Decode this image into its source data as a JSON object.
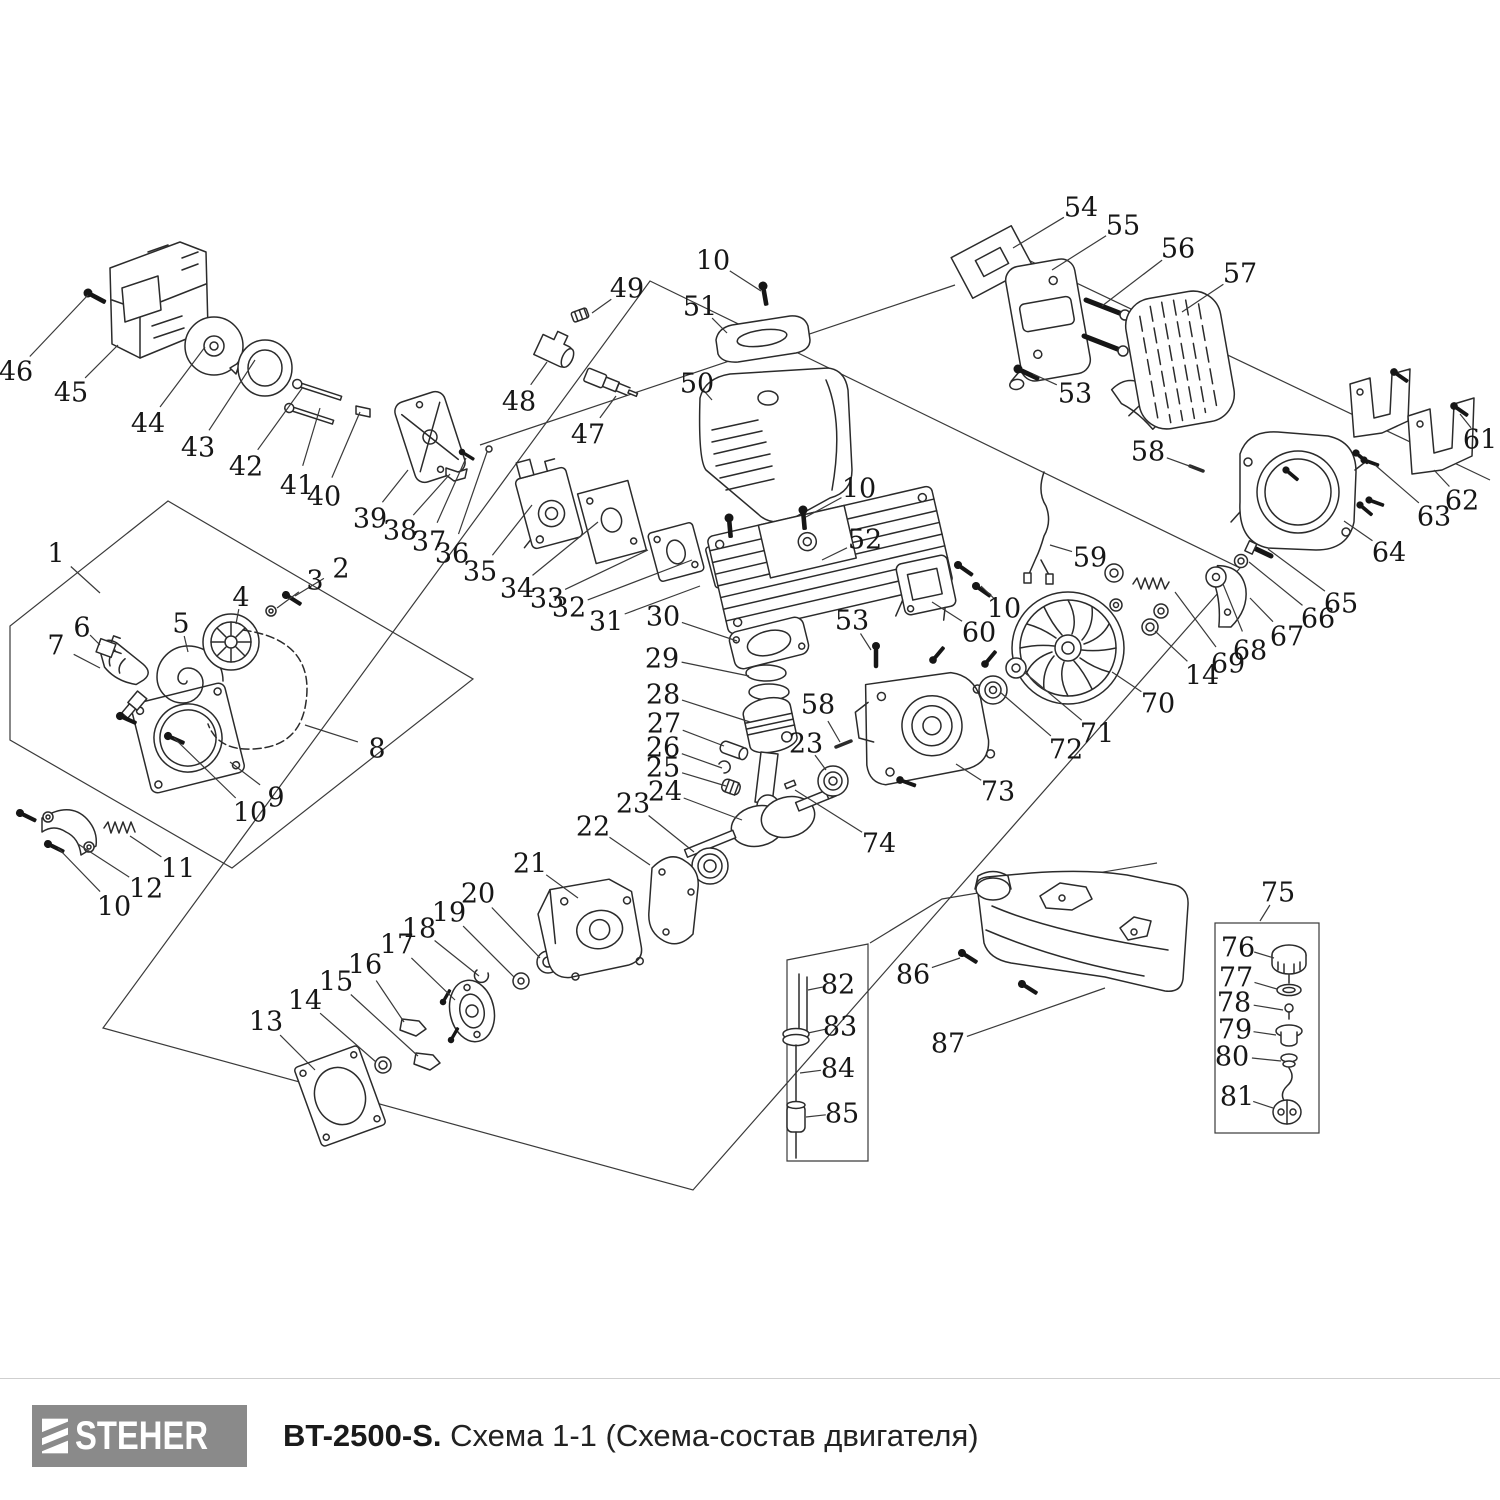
{
  "footer": {
    "brand": "STEHER",
    "model": "BT-2500-S.",
    "subtitle": "Схема 1-1 (Схема-состав двигателя)"
  },
  "colors": {
    "ink": "#2b2b2b",
    "label": "#161616",
    "leader": "#3a3a3a",
    "logo_bg": "#8a8a8a",
    "logo_fg": "#ffffff",
    "rule": "#cfcfcf"
  },
  "diagram": {
    "label_font_size": 27,
    "labels": [
      {
        "n": "46",
        "x": 16,
        "y": 371,
        "tx": 88,
        "ty": 295
      },
      {
        "n": "45",
        "x": 71,
        "y": 392,
        "tx": 118,
        "ty": 345
      },
      {
        "n": "44",
        "x": 148,
        "y": 423,
        "tx": 205,
        "ty": 347
      },
      {
        "n": "43",
        "x": 198,
        "y": 447,
        "tx": 255,
        "ty": 360
      },
      {
        "n": "42",
        "x": 246,
        "y": 466,
        "tx": 303,
        "ty": 387
      },
      {
        "n": "41",
        "x": 297,
        "y": 485,
        "tx": 320,
        "ty": 408
      },
      {
        "n": "40",
        "x": 324,
        "y": 496,
        "tx": 360,
        "ty": 412
      },
      {
        "n": "39",
        "x": 370,
        "y": 518,
        "tx": 408,
        "ty": 470
      },
      {
        "n": "38",
        "x": 400,
        "y": 530,
        "tx": 450,
        "ty": 474
      },
      {
        "n": "37",
        "x": 429,
        "y": 541,
        "tx": 466,
        "ty": 458
      },
      {
        "n": "36",
        "x": 452,
        "y": 553,
        "tx": 487,
        "ty": 452
      },
      {
        "n": "35",
        "x": 480,
        "y": 571,
        "tx": 532,
        "ty": 505
      },
      {
        "n": "34",
        "x": 517,
        "y": 588,
        "tx": 598,
        "ty": 522
      },
      {
        "n": "33",
        "x": 547,
        "y": 598,
        "tx": 648,
        "ty": 550
      },
      {
        "n": "32",
        "x": 569,
        "y": 607,
        "tx": 692,
        "ty": 560
      },
      {
        "n": "31",
        "x": 606,
        "y": 621,
        "tx": 700,
        "ty": 586
      },
      {
        "n": "30",
        "x": 663,
        "y": 616,
        "tx": 737,
        "ty": 641
      },
      {
        "n": "29",
        "x": 662,
        "y": 658,
        "tx": 749,
        "ty": 676
      },
      {
        "n": "28",
        "x": 663,
        "y": 694,
        "tx": 750,
        "ty": 722
      },
      {
        "n": "27",
        "x": 664,
        "y": 723,
        "tx": 724,
        "ty": 746
      },
      {
        "n": "26",
        "x": 663,
        "y": 747,
        "tx": 722,
        "ty": 768
      },
      {
        "n": "25",
        "x": 663,
        "y": 767,
        "tx": 726,
        "ty": 786
      },
      {
        "n": "24",
        "x": 665,
        "y": 791,
        "tx": 742,
        "ty": 820
      },
      {
        "n": "23",
        "x": 633,
        "y": 803,
        "tx": 694,
        "ty": 852
      },
      {
        "n": "22",
        "x": 593,
        "y": 826,
        "tx": 650,
        "ty": 865
      },
      {
        "n": "21",
        "x": 530,
        "y": 863,
        "tx": 578,
        "ty": 898
      },
      {
        "n": "20",
        "x": 478,
        "y": 893,
        "tx": 540,
        "ty": 958
      },
      {
        "n": "19",
        "x": 449,
        "y": 912,
        "tx": 514,
        "ty": 977
      },
      {
        "n": "18",
        "x": 419,
        "y": 928,
        "tx": 479,
        "ty": 976
      },
      {
        "n": "17",
        "x": 397,
        "y": 944,
        "tx": 455,
        "ty": 1000
      },
      {
        "n": "16",
        "x": 365,
        "y": 964,
        "tx": 404,
        "ty": 1022
      },
      {
        "n": "15",
        "x": 336,
        "y": 981,
        "tx": 418,
        "ty": 1056
      },
      {
        "n": "14",
        "x": 305,
        "y": 1000,
        "tx": 376,
        "ty": 1062
      },
      {
        "n": "13",
        "x": 266,
        "y": 1021,
        "tx": 315,
        "ty": 1070
      },
      {
        "n": "1",
        "x": 56,
        "y": 553,
        "tx": 100,
        "ty": 593
      },
      {
        "n": "2",
        "x": 341,
        "y": 568,
        "tx": 295,
        "ty": 596
      },
      {
        "n": "3",
        "x": 315,
        "y": 580,
        "tx": 277,
        "ty": 608
      },
      {
        "n": "4",
        "x": 241,
        "y": 597,
        "tx": 236,
        "ty": 624
      },
      {
        "n": "5",
        "x": 181,
        "y": 623,
        "tx": 188,
        "ty": 652
      },
      {
        "n": "6",
        "x": 82,
        "y": 627,
        "tx": 100,
        "ty": 645
      },
      {
        "n": "7",
        "x": 56,
        "y": 645,
        "tx": 100,
        "ty": 668
      },
      {
        "n": "8",
        "x": 377,
        "y": 748,
        "tx": 305,
        "ty": 725
      },
      {
        "n": "9",
        "x": 276,
        "y": 797,
        "tx": 230,
        "ty": 762
      },
      {
        "n": "10",
        "x": 250,
        "y": 812,
        "tx": 174,
        "ty": 738
      },
      {
        "n": "11",
        "x": 178,
        "y": 868,
        "tx": 130,
        "ty": 836
      },
      {
        "n": "12",
        "x": 146,
        "y": 888,
        "tx": 78,
        "ty": 844
      },
      {
        "n": "10",
        "x": 114,
        "y": 906,
        "tx": 58,
        "ty": 848
      },
      {
        "n": "47",
        "x": 588,
        "y": 434,
        "tx": 616,
        "ty": 396
      },
      {
        "n": "48",
        "x": 519,
        "y": 401,
        "tx": 547,
        "ty": 362
      },
      {
        "n": "49",
        "x": 627,
        "y": 288,
        "tx": 592,
        "ty": 313
      },
      {
        "n": "50",
        "x": 697,
        "y": 383,
        "tx": 712,
        "ty": 400
      },
      {
        "n": "51",
        "x": 700,
        "y": 306,
        "tx": 727,
        "ty": 333
      },
      {
        "n": "10",
        "x": 713,
        "y": 260,
        "tx": 761,
        "ty": 291
      },
      {
        "n": "52",
        "x": 865,
        "y": 539,
        "tx": 822,
        "ty": 560
      },
      {
        "n": "10",
        "x": 859,
        "y": 488,
        "tx": 806,
        "ty": 517
      },
      {
        "n": "53",
        "x": 1075,
        "y": 393,
        "tx": 1033,
        "ty": 374
      },
      {
        "n": "54",
        "x": 1081,
        "y": 207,
        "tx": 1013,
        "ty": 248
      },
      {
        "n": "55",
        "x": 1123,
        "y": 225,
        "tx": 1052,
        "ty": 270
      },
      {
        "n": "56",
        "x": 1178,
        "y": 248,
        "tx": 1102,
        "ty": 306
      },
      {
        "n": "57",
        "x": 1240,
        "y": 273,
        "tx": 1182,
        "ty": 312
      },
      {
        "n": "58",
        "x": 1148,
        "y": 451,
        "tx": 1192,
        "ty": 467
      },
      {
        "n": "59",
        "x": 1090,
        "y": 557,
        "tx": 1050,
        "ty": 545
      },
      {
        "n": "60",
        "x": 979,
        "y": 632,
        "tx": 932,
        "ty": 602
      },
      {
        "n": "10",
        "x": 1004,
        "y": 608,
        "tx": 981,
        "ty": 586
      },
      {
        "n": "61",
        "x": 1480,
        "y": 439,
        "tx": 1460,
        "ty": 414
      },
      {
        "n": "62",
        "x": 1462,
        "y": 500,
        "tx": 1434,
        "ty": 470
      },
      {
        "n": "63",
        "x": 1434,
        "y": 516,
        "tx": 1375,
        "ty": 465
      },
      {
        "n": "64",
        "x": 1389,
        "y": 552,
        "tx": 1344,
        "ty": 521
      },
      {
        "n": "65",
        "x": 1341,
        "y": 603,
        "tx": 1268,
        "ty": 549
      },
      {
        "n": "66",
        "x": 1318,
        "y": 618,
        "tx": 1249,
        "ty": 562
      },
      {
        "n": "67",
        "x": 1287,
        "y": 636,
        "tx": 1250,
        "ty": 598
      },
      {
        "n": "68",
        "x": 1250,
        "y": 650,
        "tx": 1223,
        "ty": 584
      },
      {
        "n": "69",
        "x": 1228,
        "y": 663,
        "tx": 1175,
        "ty": 592
      },
      {
        "n": "14",
        "x": 1202,
        "y": 675,
        "tx": 1155,
        "ty": 631
      },
      {
        "n": "70",
        "x": 1158,
        "y": 703,
        "tx": 1112,
        "ty": 672
      },
      {
        "n": "71",
        "x": 1097,
        "y": 733,
        "tx": 1024,
        "ty": 672
      },
      {
        "n": "72",
        "x": 1066,
        "y": 749,
        "tx": 1000,
        "ty": 692
      },
      {
        "n": "73",
        "x": 998,
        "y": 791,
        "tx": 956,
        "ty": 764
      },
      {
        "n": "74",
        "x": 879,
        "y": 843,
        "tx": 795,
        "ty": 790
      },
      {
        "n": "53",
        "x": 852,
        "y": 620,
        "tx": 871,
        "ty": 650
      },
      {
        "n": "58",
        "x": 818,
        "y": 704,
        "tx": 840,
        "ty": 742
      },
      {
        "n": "23",
        "x": 806,
        "y": 743,
        "tx": 826,
        "ty": 770
      },
      {
        "n": "75",
        "x": 1278,
        "y": 892,
        "tx": 1260,
        "ty": 921
      },
      {
        "n": "76",
        "x": 1238,
        "y": 947,
        "tx": 1274,
        "ty": 958
      },
      {
        "n": "77",
        "x": 1236,
        "y": 977,
        "tx": 1277,
        "ty": 989
      },
      {
        "n": "78",
        "x": 1234,
        "y": 1002,
        "tx": 1283,
        "ty": 1010
      },
      {
        "n": "79",
        "x": 1235,
        "y": 1029,
        "tx": 1276,
        "ty": 1035
      },
      {
        "n": "80",
        "x": 1232,
        "y": 1056,
        "tx": 1281,
        "ty": 1061
      },
      {
        "n": "81",
        "x": 1237,
        "y": 1096,
        "tx": 1273,
        "ty": 1108
      },
      {
        "n": "82",
        "x": 838,
        "y": 984,
        "tx": 808,
        "ty": 990
      },
      {
        "n": "83",
        "x": 840,
        "y": 1026,
        "tx": 808,
        "ty": 1033
      },
      {
        "n": "84",
        "x": 838,
        "y": 1068,
        "tx": 800,
        "ty": 1073
      },
      {
        "n": "85",
        "x": 842,
        "y": 1113,
        "tx": 806,
        "ty": 1117
      },
      {
        "n": "86",
        "x": 913,
        "y": 974,
        "tx": 960,
        "ty": 958
      },
      {
        "n": "87",
        "x": 948,
        "y": 1043,
        "tx": 1105,
        "ty": 988
      }
    ]
  }
}
